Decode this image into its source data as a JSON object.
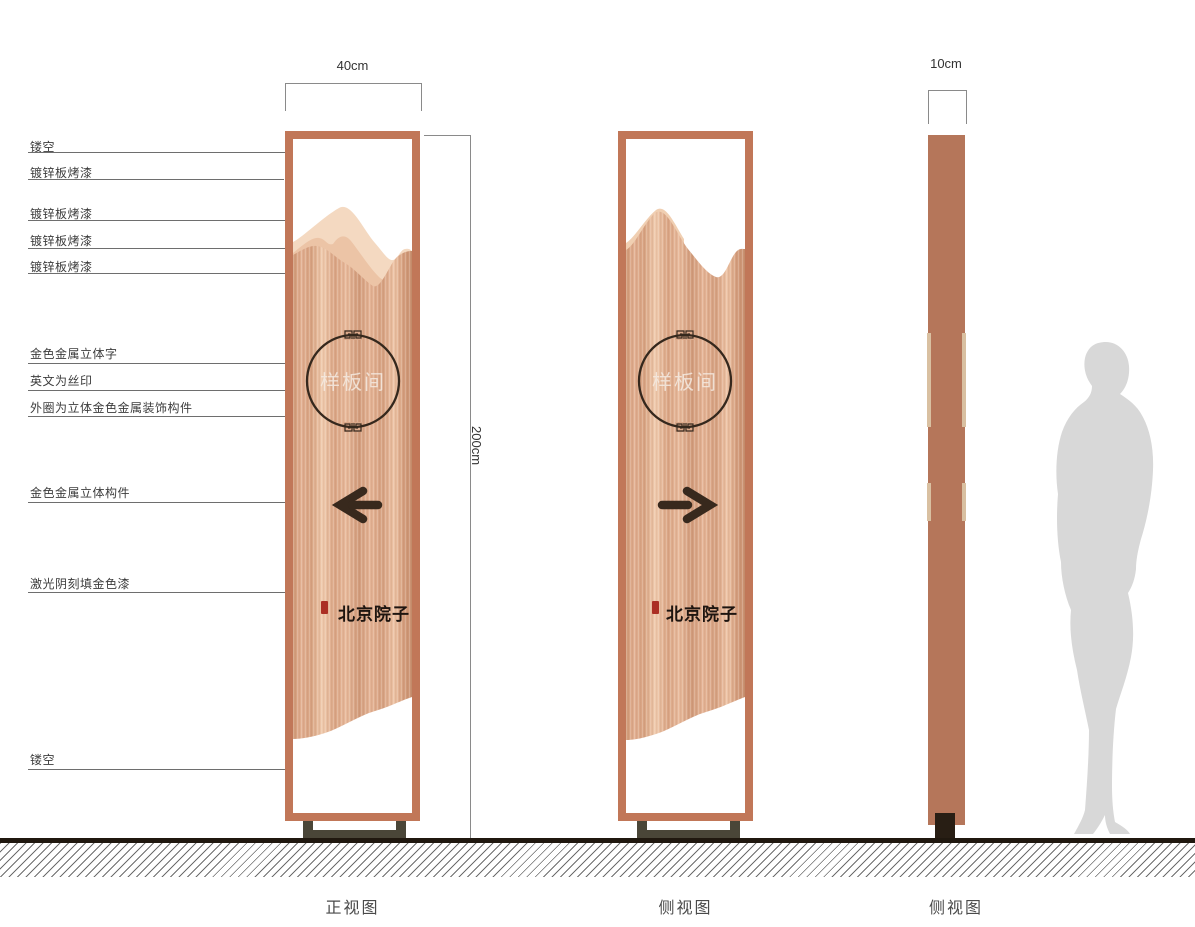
{
  "dimensions": {
    "width_label": "40cm",
    "height_label": "200cm",
    "depth_label": "10cm"
  },
  "callouts": [
    {
      "label": "镂空"
    },
    {
      "label": "镀锌板烤漆"
    },
    {
      "label": "镀锌板烤漆"
    },
    {
      "label": "镀锌板烤漆"
    },
    {
      "label": "镀锌板烤漆"
    },
    {
      "label": "金色金属立体字"
    },
    {
      "label": "英文为丝印"
    },
    {
      "label": "外圈为立体金色金属装饰构件"
    },
    {
      "label": "金色金属立体构件"
    },
    {
      "label": "激光阴刻填金色漆"
    },
    {
      "label": "镂空"
    }
  ],
  "views": {
    "front": {
      "caption": "正视图",
      "emblem": "样板间",
      "brand": "北京院子",
      "arrow_direction": "left"
    },
    "side": {
      "caption": "侧视图",
      "emblem": "样板间",
      "brand": "北京院子",
      "arrow_direction": "right"
    },
    "profile": {
      "caption": "侧视图"
    }
  },
  "colors": {
    "frame": "#c17758",
    "copper_light": "#f0cbae",
    "copper_dark": "#cf9775",
    "profile_panel": "#b5765a",
    "gold_notch": "#d9c0a1",
    "base_olive": "#4a4638",
    "accent_dark": "#38291d",
    "seal_red": "#ab2f24",
    "silhouette_gray": "#d8d8d8"
  }
}
